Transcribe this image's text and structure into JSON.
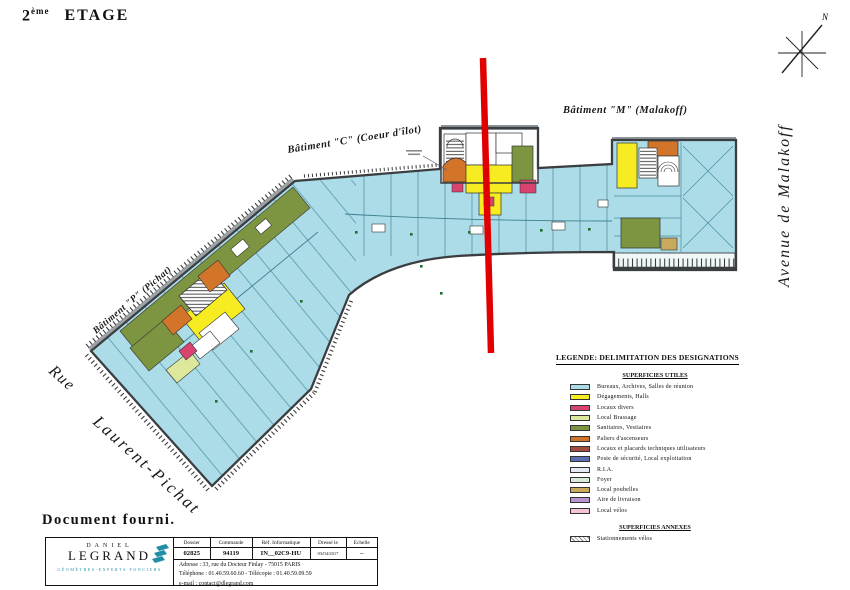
{
  "title": {
    "num": "2",
    "sup": "ème",
    "rest": "ETAGE"
  },
  "compass": {
    "north": "N"
  },
  "streets": {
    "rue": "Rue",
    "laurent_pichat": "Laurent-Pichat",
    "avenue": "Avenue de Malakoff"
  },
  "buildings": {
    "p": "Bâtiment \"P\" (Pichat)",
    "c": "Bâtiment \"C\" (Coeur d'îlot)",
    "m": "Bâtiment \"M\" (Malakoff)"
  },
  "legend": {
    "title": "LEGENDE: DELIMITATION DES DESIGNATIONS",
    "section_utiles": "SUPERFICIES UTILES",
    "items": [
      {
        "color": "#abdce8",
        "label": "Bureaux, Archives, Salles de réunion"
      },
      {
        "color": "#f6ec21",
        "label": "Dégagements, Halls"
      },
      {
        "color": "#d8436f",
        "label": "Locaux divers"
      },
      {
        "color": "#dde89c",
        "label": "Local Brassage"
      },
      {
        "color": "#7d9440",
        "label": "Sanitaires, Vestiaires"
      },
      {
        "color": "#d2742a",
        "label": "Paliers d'ascenseurs"
      },
      {
        "color": "#a34d42",
        "label": "Locaux et placards techniques utilisateurs"
      },
      {
        "color": "#5c6fb5",
        "label": "Poste de sécurité, Local exploitation"
      },
      {
        "color": "#e6e9f4",
        "label": "R.I.A."
      },
      {
        "color": "#d6ecd9",
        "label": "Foyer"
      },
      {
        "color": "#c9a95c",
        "label": "Local poubelles"
      },
      {
        "color": "#b793cf",
        "label": "Aire de livraison"
      },
      {
        "color": "#f4c4d6",
        "label": "Local vélos"
      }
    ],
    "section_annexes": "SUPERFICIES ANNEXES",
    "annex_items": [
      {
        "hatch": true,
        "label": "Stationnements vélos"
      }
    ]
  },
  "note": "Document fourni.",
  "titleblock": {
    "company": {
      "top": "DANIEL",
      "name": "LEGRAND",
      "tagline": "GÉOMÈTRES-EXPERTS FONCIERS"
    },
    "fields": {
      "headers": [
        "Dossier",
        "Commande",
        "Réf. Informatique",
        "Dressé le",
        "Echelle"
      ],
      "values": [
        "02825",
        "94119",
        "IN__02C9-HU",
        "03/04/2017",
        "–"
      ]
    },
    "address": "Adresse : 33, rue du Docteur Finlay - 75015 PARIS",
    "phone": "Téléphone : 01.40.59.60.60   -   Télécopie : 01.40.59.09.59",
    "email": "e-mail : contact@dlegrand.com"
  },
  "colors": {
    "cyan": "#abdce8",
    "yellow": "#f6ec21",
    "pink": "#d8436f",
    "brassage": "#dde89c",
    "olive": "#7d9440",
    "orange": "#d2742a",
    "red_line": "#e10000",
    "teal": "#1f8fa6",
    "wall": "#3b3e41",
    "partition": "#4b8d9e",
    "khaki": "#c9a95c"
  }
}
